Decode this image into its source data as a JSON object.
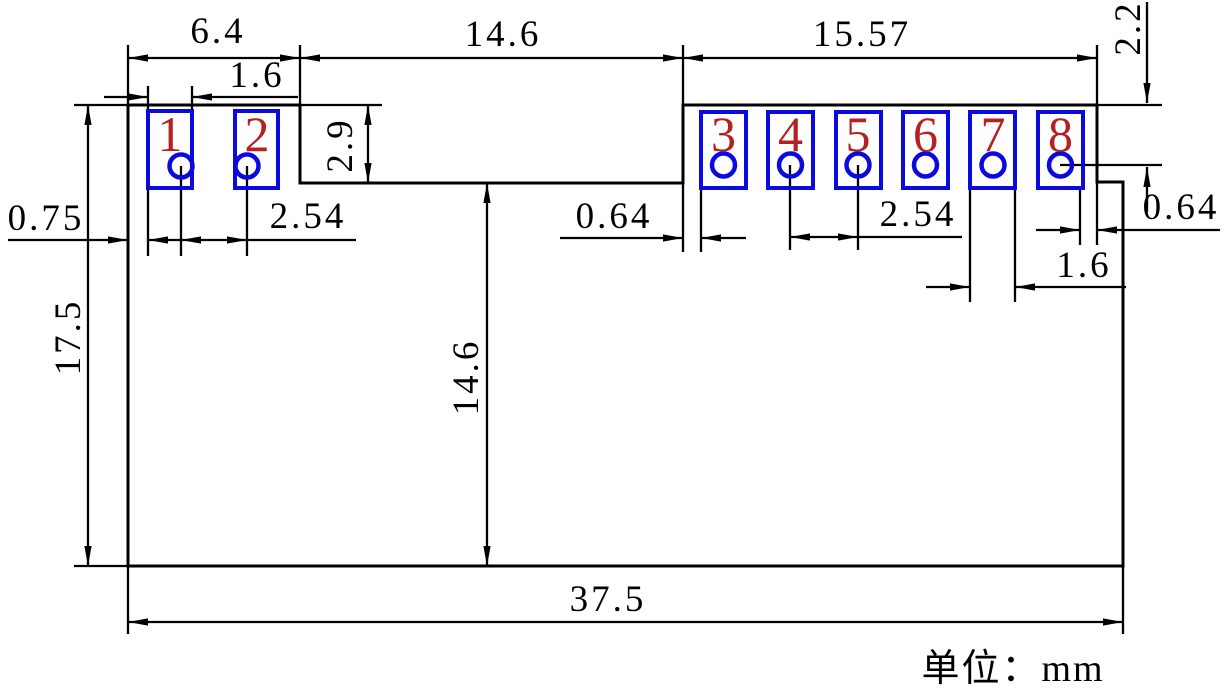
{
  "drawing": {
    "title": "pcb-module-footprint-dimension-drawing",
    "units_note": "单位：mm",
    "pins": [
      "1",
      "2",
      "3",
      "4",
      "5",
      "6",
      "7",
      "8"
    ],
    "dims": {
      "left_group_width": "6.4",
      "pad1_width": "1.6",
      "notch_width": "14.6",
      "right_group_width": "15.57",
      "top_edge_to_hole8": "2.2",
      "notch_depth": "2.9",
      "body_height": "17.5",
      "left_edge_to_pad1": "0.75",
      "left_hole_pitch": "2.54",
      "notch_to_pad3": "0.64",
      "right_hole_pitch": "2.54",
      "pad8_to_right_edge": "0.64",
      "pad7_width": "1.6",
      "notch_bottom_to_body_bottom": "14.6",
      "body_width": "37.5"
    },
    "colors": {
      "line": "#000000",
      "pad_outline": "#0a0ae0",
      "pin_number": "#b22222",
      "background": "#ffffff"
    }
  }
}
